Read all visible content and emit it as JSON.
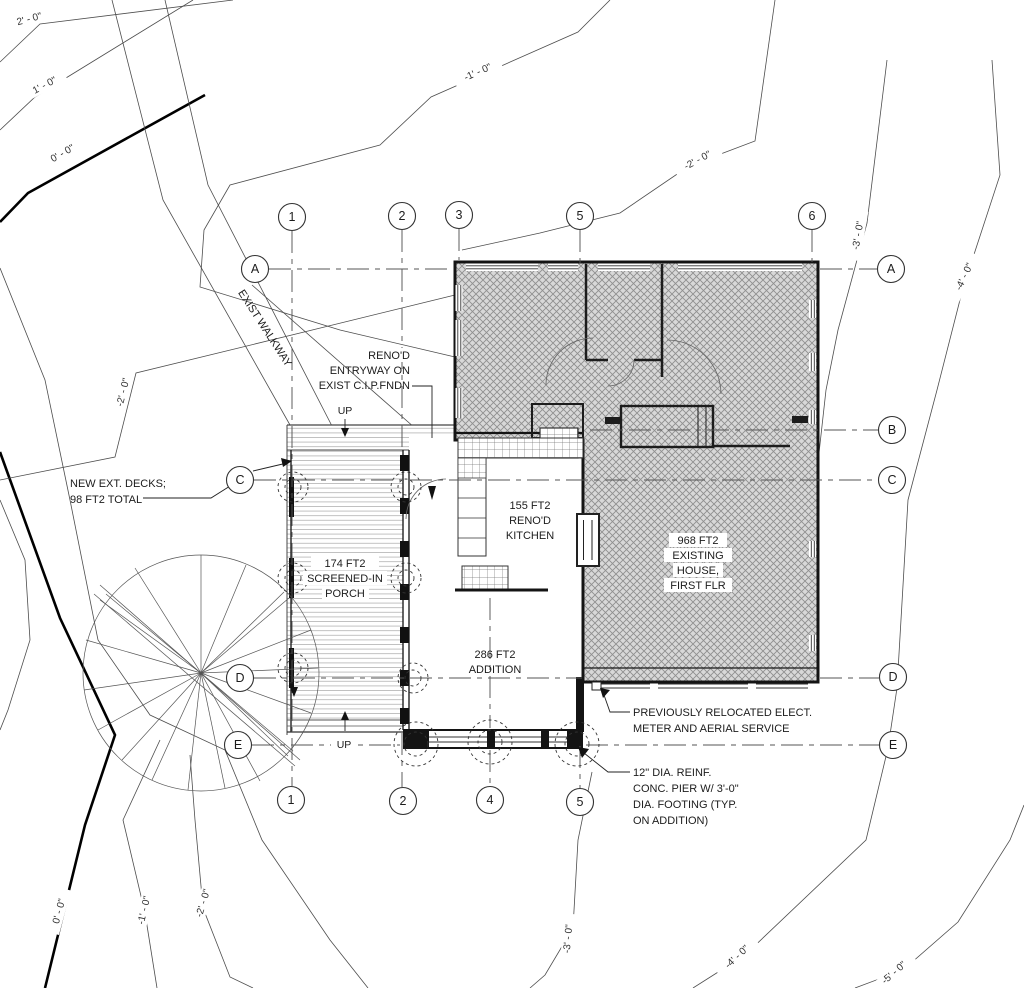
{
  "title": "Site / First Floor Plan",
  "colors": {
    "paper": "#ffffff",
    "walls": "#141414",
    "contour": "#4d4d4d",
    "hatch_fill": "#d8d8d8",
    "hatch_line": "#8f8f8f",
    "grid_line": "#555555"
  },
  "contour_labels": [
    "2' - 0\"",
    "1' - 0\"",
    "0' - 0\"",
    "-1' - 0\"",
    "-2' - 0\"",
    "-3' - 0\"",
    "-4' - 0\"",
    "-2' - 0\"",
    "0' - 0\"",
    "-1' - 0\"",
    "-2' - 0\"",
    "-3' - 0\"",
    "-4' - 0\"",
    "-5' - 0\""
  ],
  "grid_bubbles": [
    "1",
    "2",
    "3",
    "5",
    "6",
    "1",
    "2",
    "4",
    "5",
    "A",
    "C",
    "D",
    "E",
    "A",
    "B",
    "C",
    "D",
    "E"
  ],
  "walkway_label": "EXIST WALKWAY",
  "rooms": {
    "porch": [
      "174 FT2",
      "SCREENED-IN",
      "PORCH"
    ],
    "kitchen": [
      "155 FT2",
      "RENO'D",
      "KITCHEN"
    ],
    "existing_house": [
      "968 FT2",
      "EXISTING",
      "HOUSE,",
      "FIRST FLR"
    ],
    "addition": [
      "286 FT2",
      "ADDITION"
    ]
  },
  "notes": {
    "decks": [
      "NEW EXT. DECKS;",
      "98 FT2 TOTAL"
    ],
    "entry": [
      "RENO'D",
      "ENTRYWAY ON",
      "EXIST C.I.P.FNDN"
    ],
    "elect": [
      "PREVIOUSLY RELOCATED ELECT.",
      "METER AND AERIAL SERVICE"
    ],
    "pier": [
      "12\" DIA. REINF.",
      "CONC. PIER W/ 3'-0\"",
      "DIA. FOOTING (TYP.",
      "ON ADDITION)"
    ]
  },
  "up_labels": {
    "top": "UP",
    "bottom": "UP"
  }
}
